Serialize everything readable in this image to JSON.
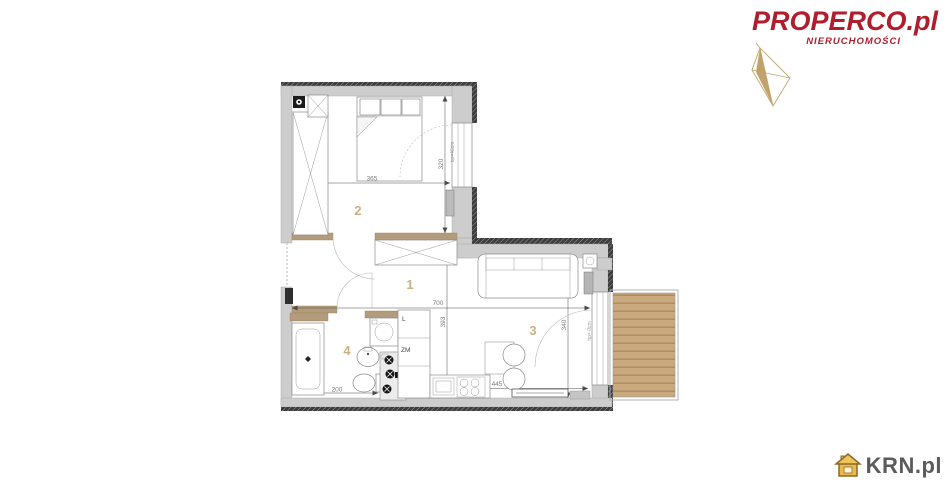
{
  "brand": {
    "name": "PROPERCO.pl",
    "tagline": "NIERUCHOMOŚCI",
    "brand_color": "#b01e2e",
    "compass_color": "#c2a26c"
  },
  "watermark": {
    "text": "KRN.pl",
    "icon": "house-icon",
    "icon_color": "#e0a93e",
    "text_color": "#5a5b5d"
  },
  "plan": {
    "rooms": [
      {
        "id": "hall",
        "number": "1"
      },
      {
        "id": "bedroom",
        "number": "2"
      },
      {
        "id": "living-kitchen",
        "number": "3"
      },
      {
        "id": "bathroom",
        "number": "4"
      }
    ],
    "dims": {
      "bedroom_width": "365",
      "bedroom_depth": "320",
      "apartment_width": "700",
      "interior_depth": "393",
      "living_depth": "340",
      "kitchen_width": "445",
      "bathroom_width": "200"
    },
    "labels": {
      "bedroom_window_sill": "hp=46cm",
      "balcony_door_sill": "hp= 0cm",
      "fridge_symbol": "L",
      "dishwasher_symbol": "ZM"
    },
    "colors": {
      "wall_gray": "#cdcdcd",
      "partition_tan": "#b29c7c",
      "deck_tan": "#c9a97e",
      "room_label_tan": "#c9b183"
    }
  }
}
